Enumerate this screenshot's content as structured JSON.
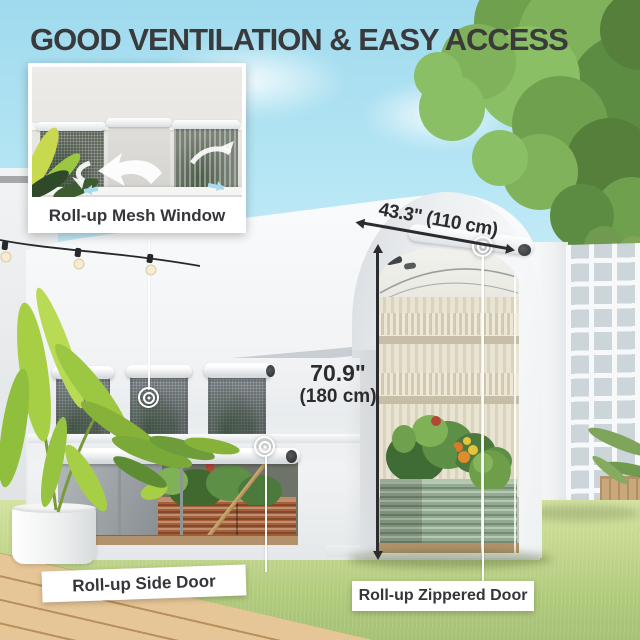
{
  "title": "GOOD VENTILATION & EASY ACCESS",
  "callouts": {
    "mesh_window": "Roll-up Mesh Window",
    "side_door": "Roll-up Side Door",
    "zippered_door": "Roll-up Zippered Door"
  },
  "dimensions": {
    "door_width": "43.3\" (110 cm)",
    "door_height_in": "70.9\"",
    "door_height_cm": "(180 cm)"
  },
  "icons": {
    "zipper_pull": "concentric-target",
    "airflow": "curved-arrow",
    "string_lights": "bulb-string"
  },
  "colors": {
    "title_text": "#3a3a3c",
    "label_bg": "#ffffff",
    "label_text": "#35363a",
    "dimension_line": "#2c2c2e",
    "sky": "#a9dff0",
    "greenhouse_cover": "#f1f3f5",
    "grass": "#bfd48d",
    "deck_wood": "#ddbb8a",
    "raised_bed_green": "#93ab91",
    "raised_bed_rust": "#a5603a"
  }
}
